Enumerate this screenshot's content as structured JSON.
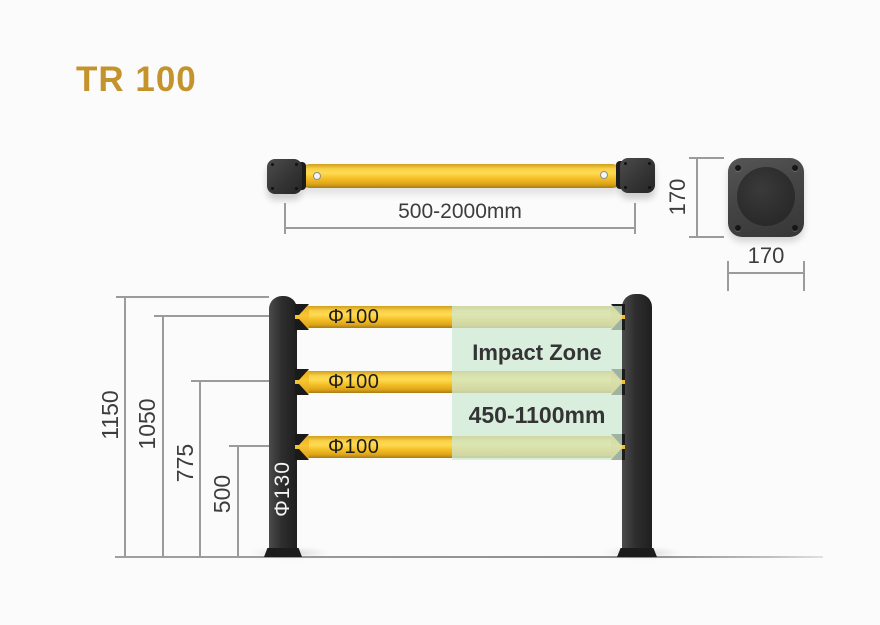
{
  "title": "TR 100",
  "colors": {
    "accent_gold": "#C4932B",
    "rail_yellow": "#F6C423",
    "post_black": "#262626",
    "impact_zone_green": "#CEE9D4",
    "dimension_text": "#3D3D3D"
  },
  "top_view": {
    "length_dimension": "500-2000mm"
  },
  "base_plate": {
    "height_dimension": "170",
    "width_dimension": "170"
  },
  "front_view": {
    "post_diameter_label": "Φ130",
    "rails": [
      {
        "diameter_label": "Φ100"
      },
      {
        "diameter_label": "Φ100"
      },
      {
        "diameter_label": "Φ100"
      }
    ],
    "impact_zone": {
      "label": "Impact Zone",
      "range": "450-1100mm"
    },
    "height_dimensions": [
      {
        "label": "1150"
      },
      {
        "label": "1050"
      },
      {
        "label": "775"
      },
      {
        "label": "500"
      }
    ]
  }
}
